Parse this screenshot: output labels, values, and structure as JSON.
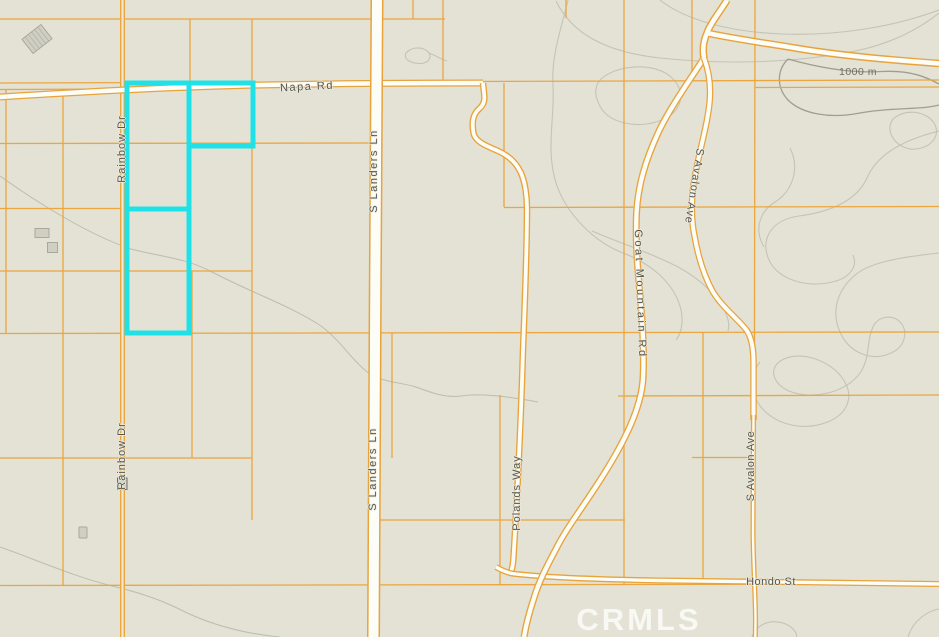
{
  "map": {
    "type": "parcel-topo-map",
    "watermark_text": "CRMLS",
    "elevation_label": "1000 m",
    "road_labels": {
      "napa_rd": "Napa Rd",
      "s_landers_ln_upper": "S Landers Ln",
      "s_landers_ln_lower": "S Landers Ln",
      "rainbow_dr_upper": "Rainbow Dr",
      "rainbow_dr_lower": "Rainbow Dr",
      "goat_mountain_rd": "Goat Mountain Rd",
      "s_avalon_ave_upper": "S Avalon Ave",
      "s_avalon_ave_lower": "S Avalon Ave",
      "polands_way": "Polands Way",
      "hondo_st": "Hondo St"
    },
    "highlight_parcels_count": 3,
    "colors": {
      "map-bg": "#e3e2d4",
      "parcel-line": "#eca63f",
      "road-casing": "#e8a33c",
      "road-fill": "#fdfdf8",
      "minor-road-fill": "#efe8d4",
      "contour": "#c4c4b6",
      "contour-index": "#9f9f91",
      "wash": "#bdbdaf",
      "highlight": "#1fe1e8",
      "building-fill": "#cfcfc4",
      "building-stroke": "#a8a89c",
      "label-text": "#56564e",
      "elevation-text": "#6e6e63",
      "watermark": "rgba(255,255,255,0.75)"
    }
  }
}
